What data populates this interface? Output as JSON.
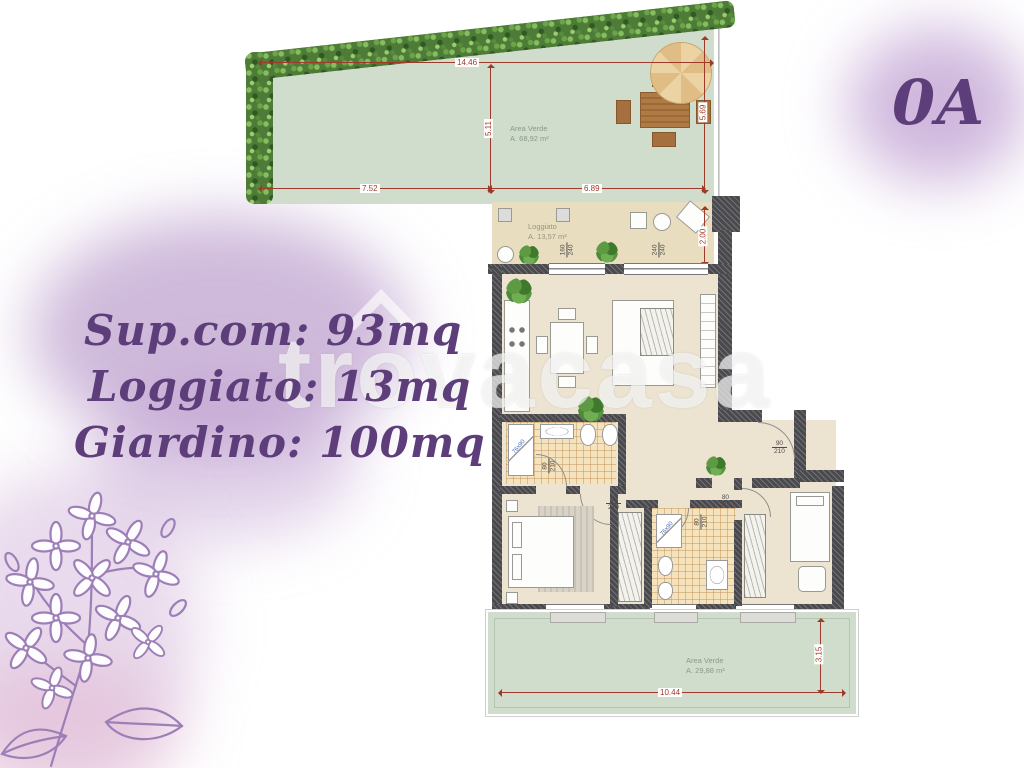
{
  "unit": {
    "label": "0A"
  },
  "watermark": {
    "text": "trovacasa"
  },
  "specs": {
    "supcom": "Sup.com: 93mq",
    "loggiato": "Loggiato: 13mq",
    "giardino": "Giardino: 100mq"
  },
  "garden_top": {
    "label": "Area Verde",
    "area": "A. 68,92 m²",
    "dim_top": "14.46",
    "dim_mid": "5.11",
    "dim_right": "5.69",
    "dim_bottom_left": "7.52",
    "dim_bottom_right": "6.89"
  },
  "loggia": {
    "label": "Loggiato",
    "area": "A. 13,57 m²",
    "dim_right": "2.00"
  },
  "garden_bottom": {
    "label": "Area Verde",
    "area": "A. 29,88 m²",
    "dim_bottom": "10.44",
    "dim_right": "3.15"
  },
  "openings": {
    "win_top_1": {
      "w": "160",
      "h": "240"
    },
    "win_top_2": {
      "w": "240",
      "h": "240"
    },
    "door_bath1": {
      "w": "80",
      "h": "210"
    },
    "door_bed1": {
      "w": "80",
      "h": "210"
    },
    "door_bath2": {
      "w": "80",
      "h": "210"
    },
    "door_bed2": {
      "w": "80",
      "h": "210"
    },
    "door_entry": {
      "w": "90",
      "h": "210"
    },
    "win_bot_1": {
      "w": "160",
      "h": "240"
    },
    "win_bot_2": {
      "w": "60",
      "h": "140"
    },
    "win_bot_3": {
      "w": "160",
      "h": "240"
    }
  },
  "fixtures": {
    "shower_label": "76x90"
  }
}
